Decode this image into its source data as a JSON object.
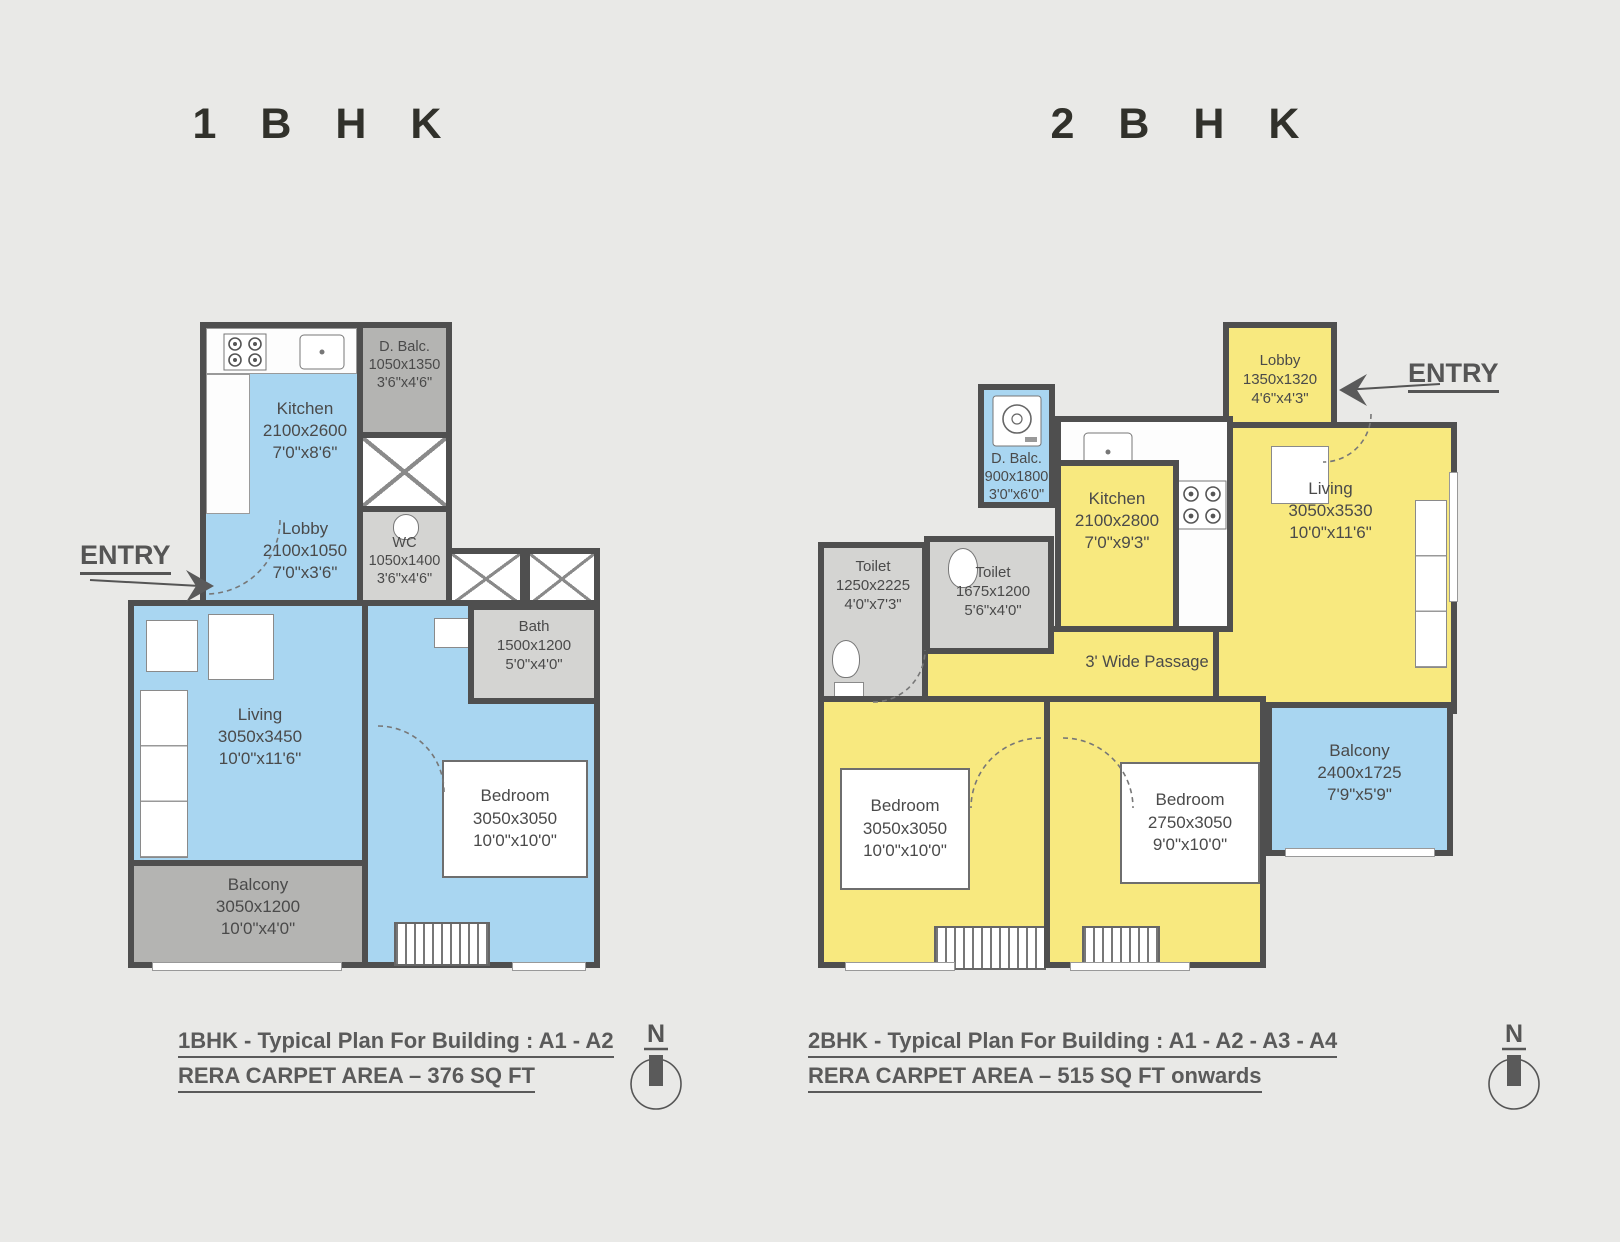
{
  "titles": {
    "plan1": "1 B H K",
    "plan2": "2 B H K"
  },
  "colors": {
    "rooms_1bhk": "#a9d6f1",
    "rooms_2bhk": "#f8e97f",
    "balcony_gray": "#b4b4b2",
    "wet_gray": "#d4d4d2",
    "wall": "#4f4f4f",
    "background": "#e9e9e7"
  },
  "plan1": {
    "entry": "ENTRY",
    "north": "N",
    "caption": "1BHK - Typical Plan For Building : A1 - A2",
    "rera": "RERA CARPET AREA – 376 SQ FT",
    "rooms": {
      "kitchen": {
        "name": "Kitchen",
        "mm": "2100x2600",
        "ft": "7'0\"x8'6\""
      },
      "dbalc": {
        "name": "D. Balc.",
        "mm": "1050x1350",
        "ft": "3'6\"x4'6\""
      },
      "lobby": {
        "name": "Lobby",
        "mm": "2100x1050",
        "ft": "7'0\"x3'6\""
      },
      "wc": {
        "name": "WC",
        "mm": "1050x1400",
        "ft": "3'6\"x4'6\""
      },
      "bath": {
        "name": "Bath",
        "mm": "1500x1200",
        "ft": "5'0\"x4'0\""
      },
      "living": {
        "name": "Living",
        "mm": "3050x3450",
        "ft": "10'0\"x11'6\""
      },
      "bedroom": {
        "name": "Bedroom",
        "mm": "3050x3050",
        "ft": "10'0\"x10'0\""
      },
      "balcony": {
        "name": "Balcony",
        "mm": "3050x1200",
        "ft": "10'0\"x4'0\""
      }
    }
  },
  "plan2": {
    "entry": "ENTRY",
    "north": "N",
    "caption": "2BHK - Typical Plan For Building : A1 - A2 - A3 - A4",
    "rera": "RERA CARPET AREA – 515 SQ FT onwards",
    "passage": "3' Wide Passage",
    "rooms": {
      "lobby": {
        "name": "Lobby",
        "mm": "1350x1320",
        "ft": "4'6\"x4'3\""
      },
      "dbalc": {
        "name": "D. Balc.",
        "mm": "900x1800",
        "ft": "3'0\"x6'0\""
      },
      "kitchen": {
        "name": "Kitchen",
        "mm": "2100x2800",
        "ft": "7'0\"x9'3\""
      },
      "toilet_a": {
        "name": "Toilet",
        "mm": "1250x2225",
        "ft": "4'0\"x7'3\""
      },
      "toilet_b": {
        "name": "Toilet",
        "mm": "1675x1200",
        "ft": "5'6\"x4'0\""
      },
      "living": {
        "name": "Living",
        "mm": "3050x3530",
        "ft": "10'0\"x11'6\""
      },
      "bedroom_a": {
        "name": "Bedroom",
        "mm": "3050x3050",
        "ft": "10'0\"x10'0\""
      },
      "bedroom_b": {
        "name": "Bedroom",
        "mm": "2750x3050",
        "ft": "9'0\"x10'0\""
      },
      "balcony": {
        "name": "Balcony",
        "mm": "2400x1725",
        "ft": "7'9\"x5'9\""
      }
    }
  }
}
